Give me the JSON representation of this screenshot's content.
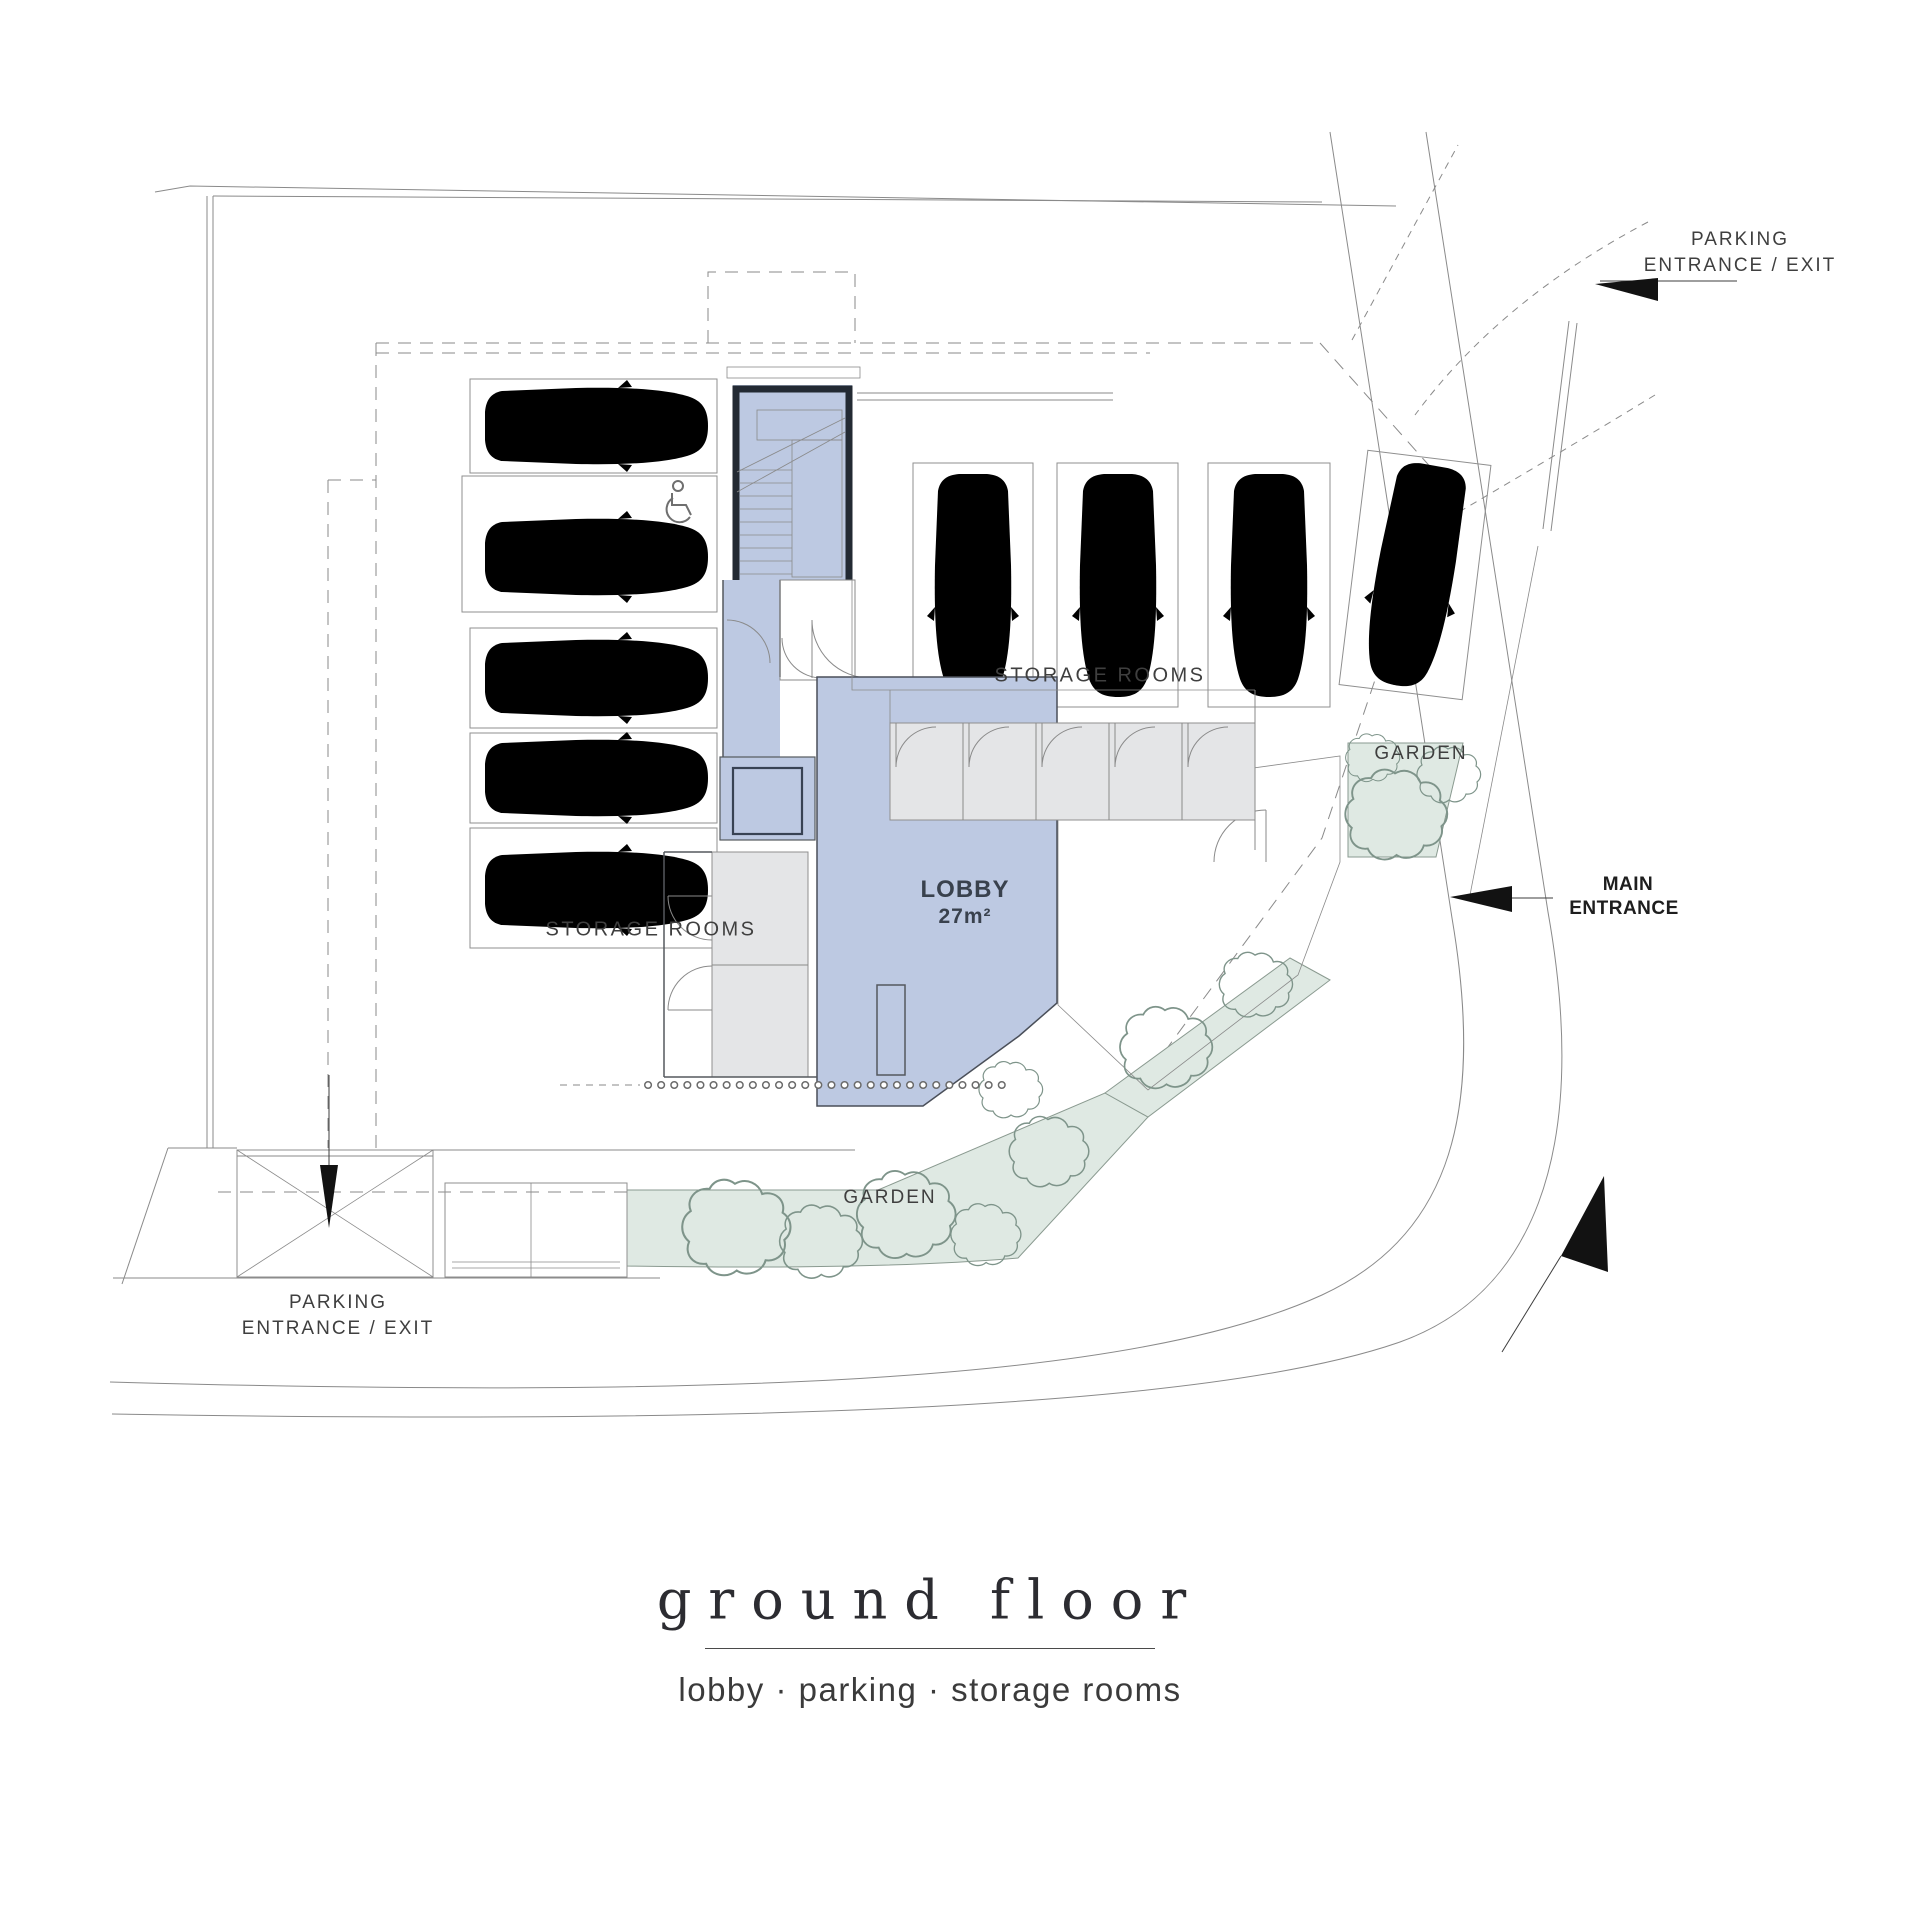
{
  "labels": {
    "parking_entrance_top": {
      "line1": "PARKING",
      "line2": "ENTRANCE / EXIT"
    },
    "main_entrance": {
      "line1": "MAIN",
      "line2": "ENTRANCE"
    },
    "storage_rooms_left": "STORAGE ROOMS",
    "storage_rooms_right": "STORAGE ROOMS",
    "garden_top": "GARDEN",
    "garden_bottom": "GARDEN",
    "lobby": {
      "name": "LOBBY",
      "area": "27m²"
    },
    "parking_entrance_bottom": {
      "line1": "PARKING",
      "line2": "ENTRANCE / EXIT"
    }
  },
  "title_block": {
    "title": "ground floor",
    "subtitle": "lobby · parking · storage rooms"
  },
  "plan_stats": {
    "cars_shown": 9,
    "parking_spaces_left_column": 5,
    "parking_spaces_middle_row": 3,
    "parking_spaces_right_tilted": 1,
    "storage_cells_right": 5,
    "storage_cells_left": 2,
    "accessible_space_marked": true,
    "lobby_area_label": "27m²"
  },
  "colors": {
    "lobby_fill": "#bdc9e2",
    "core_wall": "#232a33",
    "storage_fill": "#e4e5e7",
    "garden_fill": "#dfe9e3",
    "garden_dot": "#63806f",
    "line": "#8a8a8a",
    "line_dark": "#55595e",
    "text": "#3f3f3f",
    "text_dark": "#1e1e1e",
    "accent_black": "#121212"
  }
}
